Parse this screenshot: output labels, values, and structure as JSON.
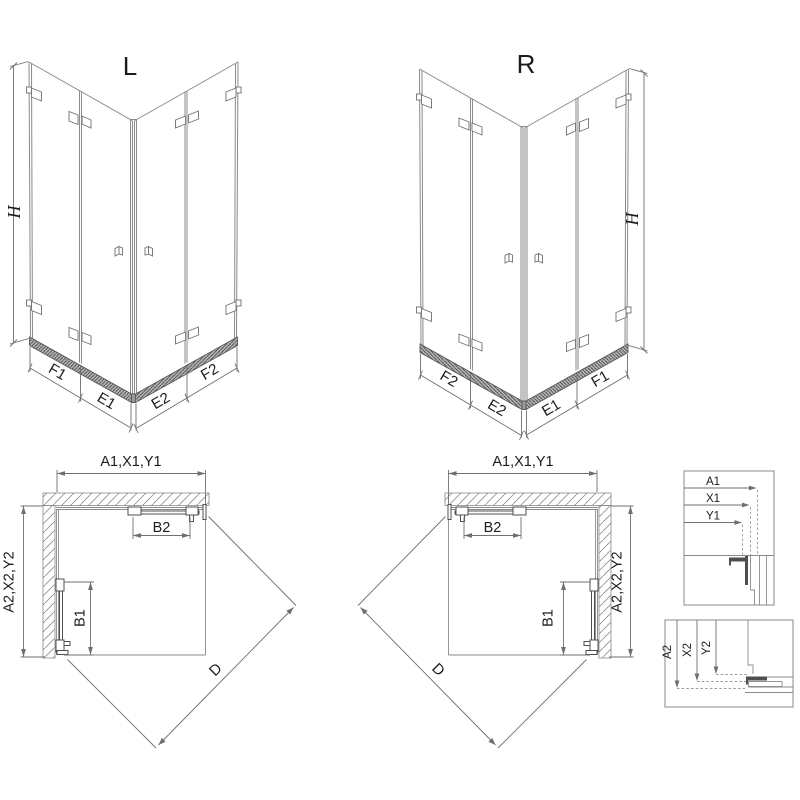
{
  "iso_left": {
    "title": "L",
    "height_label": "H",
    "bottom_labels": [
      "F1",
      "E1",
      "E2",
      "F2"
    ]
  },
  "iso_right": {
    "title": "R",
    "height_label": "H",
    "bottom_labels": [
      "F2",
      "E2",
      "E1",
      "F1"
    ]
  },
  "plan_left": {
    "top_dim": "A1,X1,Y1",
    "side_dim": "A2,X2,Y2",
    "top_door_dim": "B2",
    "side_door_dim": "B1",
    "diagonal_dim": "D"
  },
  "plan_right": {
    "top_dim": "A1,X1,Y1",
    "side_dim": "A2,X2,Y2",
    "top_door_dim": "B2",
    "side_door_dim": "B1",
    "diagonal_dim": "D"
  },
  "detail_horizontal": {
    "labels": [
      "A1",
      "X1",
      "Y1"
    ]
  },
  "detail_vertical": {
    "labels": [
      "A2",
      "X2",
      "Y2"
    ]
  },
  "colors": {
    "line": "#8a8a8a",
    "hardware": "#4f4f4f",
    "dimension": "#6f6f6f",
    "text": "#1c1c1c"
  }
}
